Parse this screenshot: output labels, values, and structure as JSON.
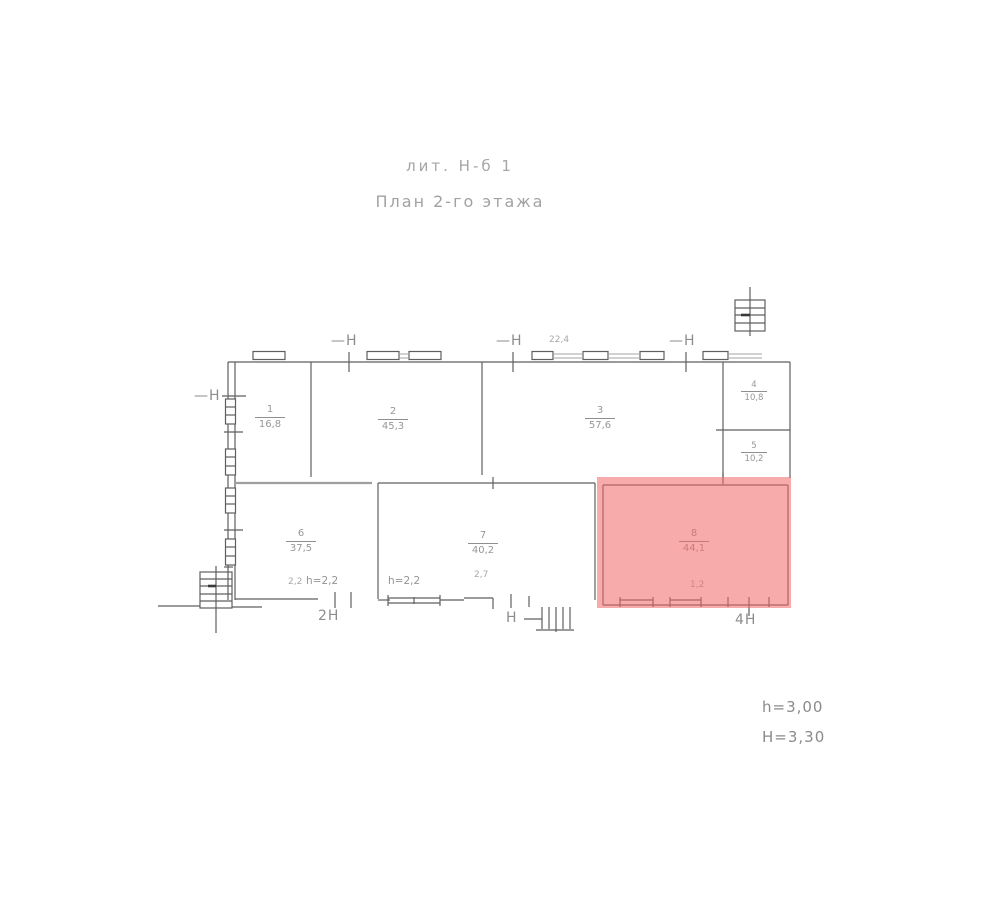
{
  "title": {
    "line1": "лит. Н-б 1",
    "line2": "План 2-го этажа"
  },
  "notes": {
    "ceiling_height": "h=3,00",
    "building_height": "Н=3,30"
  },
  "markers": {
    "top_1": "—Н",
    "top_2": "—Н",
    "top_3": "—Н",
    "left": "—Н",
    "bottom_left": "2Н",
    "bottom_middle": "Н",
    "bottom_right": "4Н"
  },
  "dimensions": {
    "top_wall": "22,4",
    "room6_prefix": "2,2",
    "room6_height": "h=2,2",
    "room7_height": "h=2,2",
    "porch": "2,7",
    "pink_room_dim": "1,2"
  },
  "rooms": [
    {
      "name": "room-1-top-left",
      "number": "1",
      "area": "16,8"
    },
    {
      "name": "room-2-top-middle",
      "number": "2",
      "area": "45,3"
    },
    {
      "name": "room-3-top-right",
      "number": "3",
      "area": "57,6"
    },
    {
      "name": "room-4-right-upper",
      "number": "4",
      "area": "10,8"
    },
    {
      "name": "room-5-right-lower",
      "number": "5",
      "area": "10,2"
    },
    {
      "name": "room-6-bottom-left",
      "number": "6",
      "area": "37,5"
    },
    {
      "name": "room-7-bottom-middle",
      "number": "7",
      "area": "40,2"
    },
    {
      "name": "room-8-highlighted",
      "number": "8",
      "area": "44,1"
    }
  ],
  "highlight": {
    "room": "room-8-highlighted",
    "color": "#f26666"
  }
}
